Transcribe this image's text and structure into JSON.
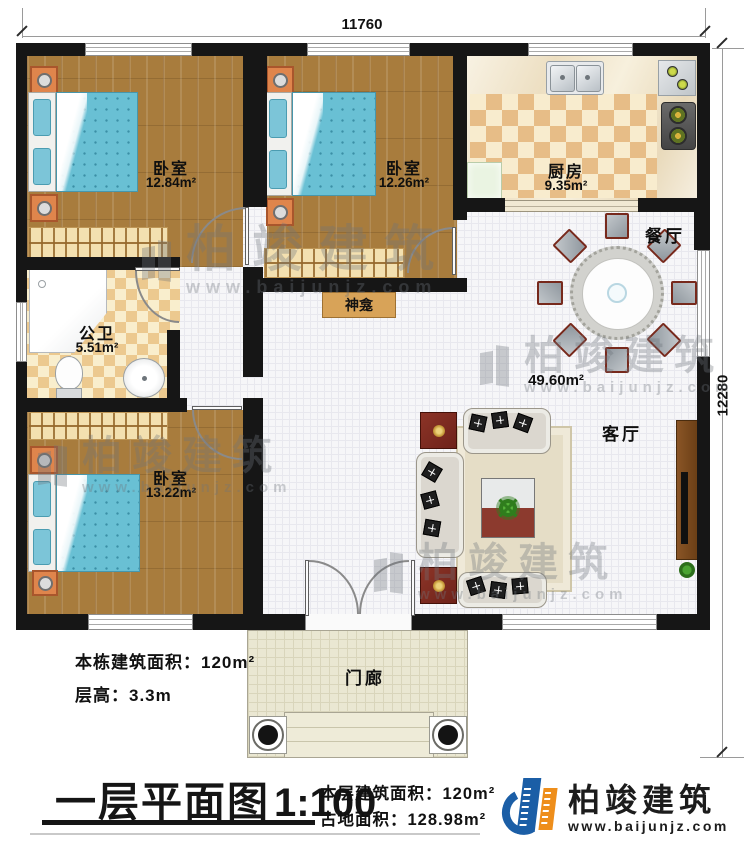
{
  "dimensions": {
    "width": "11760",
    "height": "12280"
  },
  "rooms": {
    "bedroom1": {
      "name": "卧室",
      "area": "12.84m²"
    },
    "bedroom2": {
      "name": "卧室",
      "area": "12.26m²"
    },
    "kitchen": {
      "name": "厨房",
      "area": "9.35m²"
    },
    "dining": {
      "name": "餐厅"
    },
    "bathroom": {
      "name": "公卫",
      "area": "5.51m²"
    },
    "shrine": {
      "name": "神龛"
    },
    "living": {
      "name": "客厅",
      "area": "49.60m²"
    },
    "bedroom3": {
      "name": "卧室",
      "area": "13.22m²"
    },
    "porch": {
      "name": "门廊"
    }
  },
  "plan_notes": {
    "building_area_label": "本栋建筑面积：",
    "building_area_value": "120m²",
    "floor_height_label": "层高：",
    "floor_height_value": "3.3m"
  },
  "title_block": {
    "title": "一层平面图",
    "scale": "1:100",
    "floor_area_label": "本层建筑面积：",
    "floor_area_value": "120m²",
    "land_area_label": "占地面积：",
    "land_area_value": "128.98m²"
  },
  "brand": {
    "name": "柏竣建筑",
    "url": "www.baijunjz.com"
  },
  "watermark": {
    "name": "柏竣建筑",
    "url": "www.baijunjz.com"
  },
  "colors": {
    "wall": "#161616",
    "accent_blue": "#1b5ea6",
    "accent_orange": "#ee8e1b",
    "bed": "#69c0d4",
    "nightstand": "#df854c"
  }
}
